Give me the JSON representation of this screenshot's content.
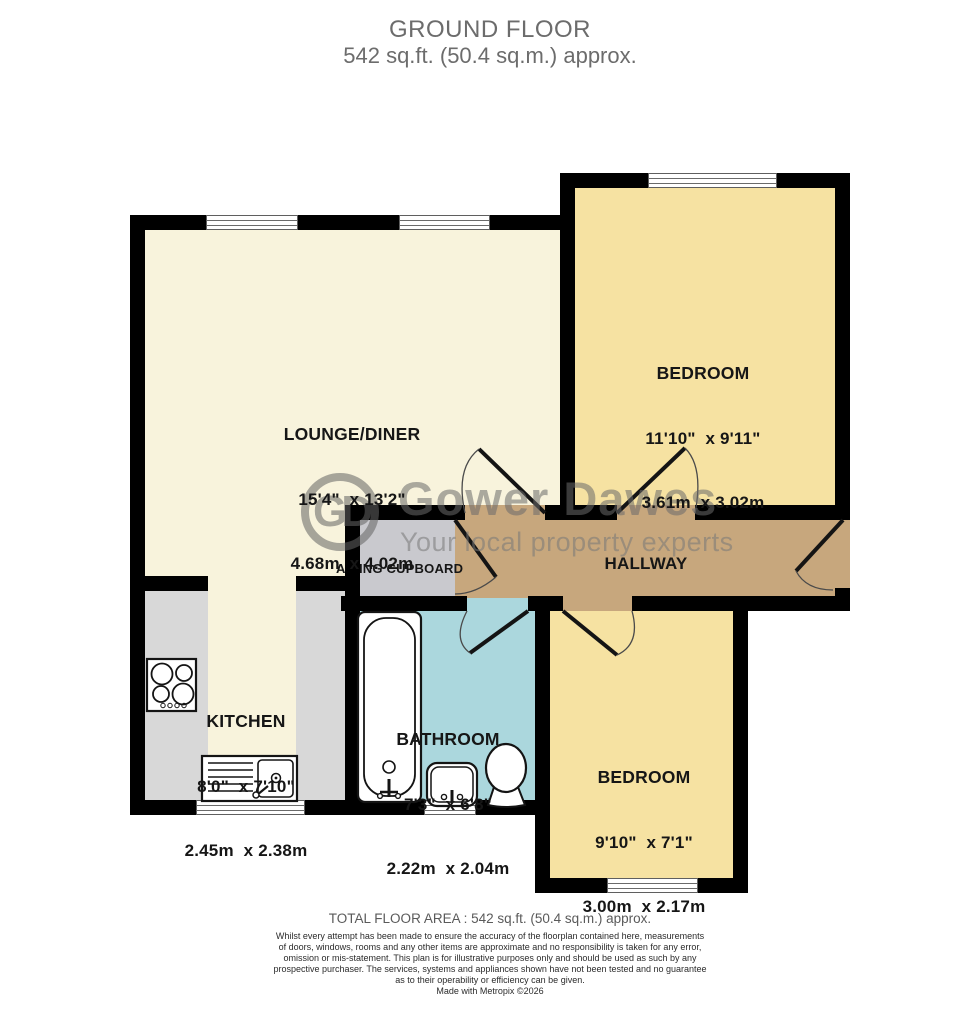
{
  "header": {
    "title": "GROUND FLOOR",
    "subtitle": "542 sq.ft. (50.4 sq.m.) approx."
  },
  "plan": {
    "rooms": [
      {
        "key": "lounge-diner",
        "name": "LOUNGE/DINER",
        "dims_ft": "15'4\"  x 13'2\"",
        "dims_m": "4.68m  x 4.02m"
      },
      {
        "key": "bedroom-1",
        "name": "BEDROOM",
        "dims_ft": "11'10\"  x 9'11\"",
        "dims_m": "3.61m  x 3.02m"
      },
      {
        "key": "kitchen",
        "name": "KITCHEN",
        "dims_ft": "8'0\"  x 7'10\"",
        "dims_m": "2.45m  x 2.38m"
      },
      {
        "key": "bathroom",
        "name": "BATHROOM",
        "dims_ft": "7'3\"  x 6'8\"",
        "dims_m": "2.22m  x 2.04m"
      },
      {
        "key": "bedroom-2",
        "name": "BEDROOM",
        "dims_ft": "9'10\"  x 7'1\"",
        "dims_m": "3.00m  x 2.17m"
      },
      {
        "key": "hallway",
        "name": "HALLWAY"
      },
      {
        "key": "airing-cupboard",
        "name": "AIRING CUPBOARD"
      }
    ],
    "fixtures": [
      "hob",
      "kitchen-sink",
      "bathtub",
      "wash-basin",
      "toilet"
    ],
    "colors": {
      "lounge_kitchen_floor": "#F8F3DC",
      "bedroom_floor": "#F6E2A2",
      "bathroom_floor": "#ABD7DD",
      "hallway_floor": "#C7A77D",
      "counter_gray": "#D8D8D8",
      "cupboard_gray": "#C9C9CE",
      "wall": "#000000"
    }
  },
  "watermark": {
    "initials": "GD",
    "brand": "Gower Dawes",
    "tagline": "Your local property experts"
  },
  "footer": {
    "total_area": "TOTAL FLOOR AREA : 542 sq.ft. (50.4 sq.m.) approx.",
    "disclaimer_lines": [
      "Whilst every attempt has been made to ensure the accuracy of the floorplan contained here, measurements",
      "of doors, windows, rooms and any other items are approximate and no responsibility is taken for any error,",
      "omission or mis-statement. This plan is for illustrative purposes only and should be used as such by any",
      "prospective purchaser. The services, systems and appliances shown have not been tested and no guarantee",
      "as to their operability or efficiency can be given."
    ],
    "credit": "Made with Metropix ©2026"
  }
}
